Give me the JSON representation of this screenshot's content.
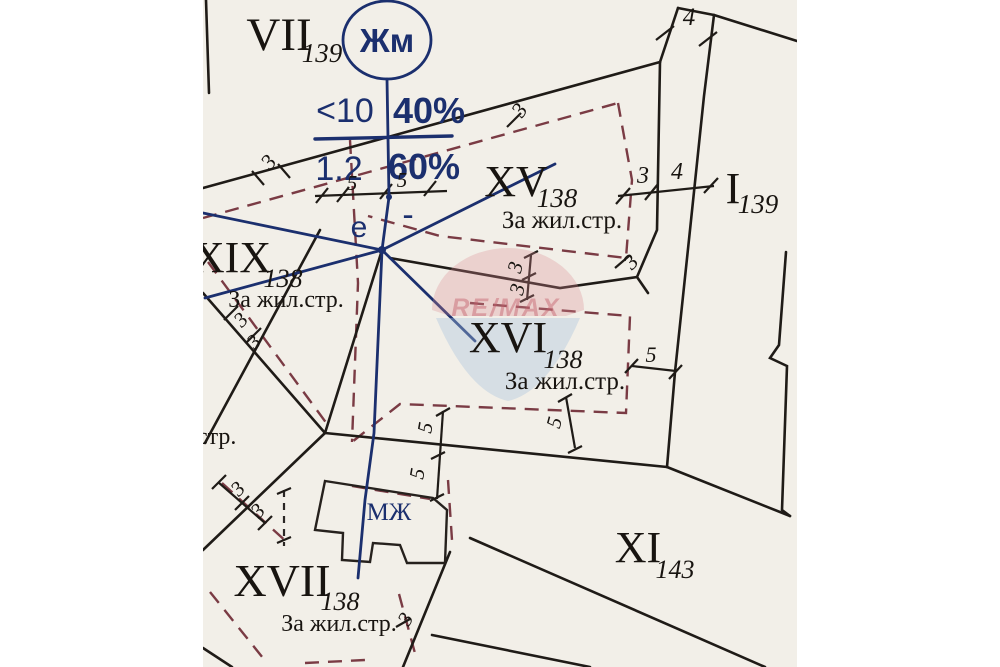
{
  "colors": {
    "background": "#f2efe8",
    "ink": "#1f1b17",
    "blue": "#1b2f6e",
    "dash_red": "#7a3b44",
    "watermark_red": "#d98a92",
    "watermark_blue": "#a9c2de"
  },
  "symbol": {
    "circle_label": "Жм"
  },
  "ratio_table": {
    "top_left": "<10",
    "top_right": "40%",
    "bottom_left": "1.2",
    "bottom_right": "60%",
    "note_left": "е",
    "note_right": "-"
  },
  "parcels": {
    "vii": {
      "num": "VII",
      "sub": "139"
    },
    "xv": {
      "num": "XV",
      "sub": "138",
      "use": "За жил.стр."
    },
    "i": {
      "num": "I",
      "sub": "139"
    },
    "xix": {
      "num": "XIX",
      "sub": "138",
      "use": "За жил.стр."
    },
    "xvi": {
      "num": "XVI",
      "sub": "138",
      "use": "За жил.стр."
    },
    "xvii": {
      "num": "XVII",
      "sub": "138",
      "use": "За жил.стр."
    },
    "xi": {
      "num": "XI",
      "sub": "143"
    }
  },
  "building": {
    "label": "МЖ"
  },
  "edge_text": "стр.",
  "dims": {
    "top_width": "4",
    "strip_left": "3",
    "strip_right": "4",
    "l1": "3",
    "hub_left": "5",
    "hub_right": "5",
    "xv_top": "3",
    "xv_corner": "3",
    "xv_gap_a": "3",
    "xv_gap_b": "3",
    "xvi_right": "5",
    "mid_a": "5",
    "mid_b": "5",
    "xvi_bottom": "5",
    "xix_a": "3",
    "xix_b": "3",
    "xvii_a": "3",
    "xvii_b": "3",
    "xvii_right": "3"
  },
  "watermark": {
    "text": "RE/MAX"
  }
}
